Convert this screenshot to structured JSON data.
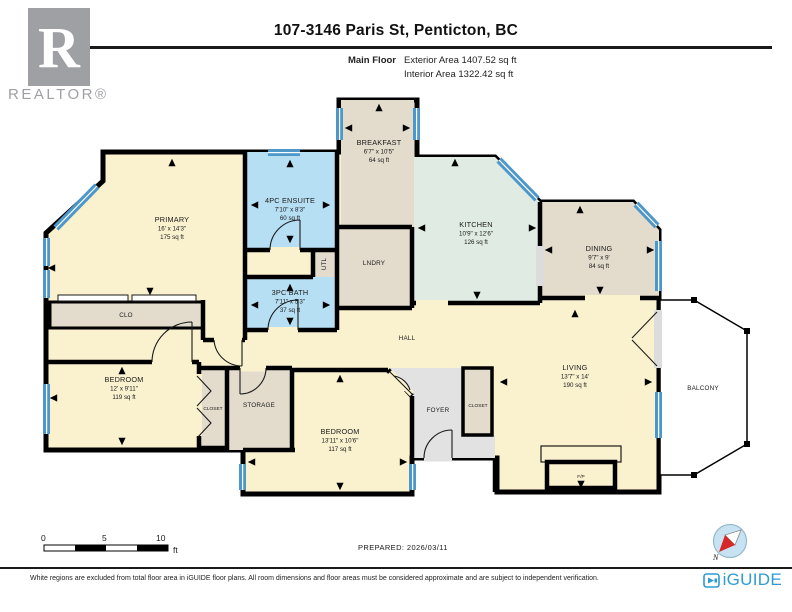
{
  "header": {
    "title": "107-3146 Paris St, Penticton, BC",
    "floor_label": "Main Floor",
    "exterior_area": "Exterior Area 1407.52 sq ft",
    "interior_area": "Interior Area 1322.42 sq ft"
  },
  "branding": {
    "realtor_r": "R",
    "realtor_text": "REALTOR®",
    "iguide_text": "iGUIDE",
    "compass_north": "N"
  },
  "rooms": {
    "breakfast": {
      "name": "BREAKFAST",
      "dims": "6'7\" x 10'5\"",
      "area": "64 sq ft"
    },
    "kitchen": {
      "name": "KITCHEN",
      "dims": "10'9\" x 12'6\"",
      "area": "126 sq ft"
    },
    "dining": {
      "name": "DINING",
      "dims": "9'7\" x 9'",
      "area": "84 sq ft"
    },
    "primary": {
      "name": "PRIMARY",
      "dims": "16' x 14'3\"",
      "area": "175 sq ft"
    },
    "ensuite": {
      "name": "4PC ENSUITE",
      "dims": "7'10\" x 8'3\"",
      "area": "60 sq ft"
    },
    "bath": {
      "name": "3PC BATH",
      "dims": "7'11\" x 5'3\"",
      "area": "37 sq ft"
    },
    "bedroom1": {
      "name": "BEDROOM",
      "dims": "12' x 9'11\"",
      "area": "119 sq ft"
    },
    "bedroom2": {
      "name": "BEDROOM",
      "dims": "13'11\" x 10'6\"",
      "area": "117 sq ft"
    },
    "living": {
      "name": "LIVING",
      "dims": "13'7\" x 14'",
      "area": "190 sq ft"
    }
  },
  "labels": {
    "hall": "HALL",
    "clo": "CLO",
    "utl": "UTL",
    "lndry": "LNDRY",
    "closet_bedroom": "CLOSET",
    "storage": "STORAGE",
    "foyer": "FOYER",
    "closet_foyer": "CLOSET",
    "balcony": "BALCONY",
    "fireplace": "F/P"
  },
  "scale": {
    "zero": "0",
    "five": "5",
    "ten": "10",
    "unit": "ft"
  },
  "footer": {
    "prepared": "PREPARED: 2026/03/11",
    "disclaimer": "White regions are excluded from total floor area in iGUIDE floor plans. All room dimensions and floor areas must be considered approximate and are subject to independent verification."
  },
  "colors": {
    "wall": "#000000",
    "interior_cream": "#FAF1CF",
    "tan": "#E3DBCC",
    "bath_blue": "#B7DFF4",
    "kitchen_mint": "#DFEBE3",
    "foyer_gray": "#E2E2E2",
    "window_blue": "#4E97C9",
    "iguide_blue": "#2E9BD6",
    "realtor_gray": "#9FA0A4"
  }
}
